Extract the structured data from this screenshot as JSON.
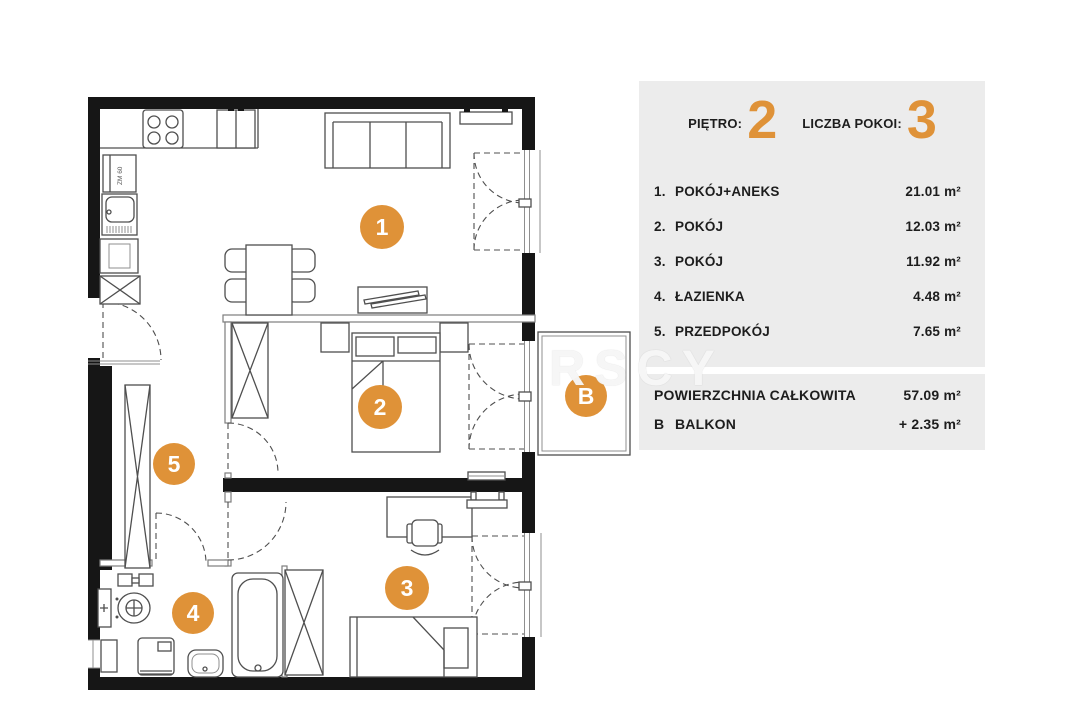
{
  "plan": {
    "markers": [
      "1",
      "2",
      "3",
      "4",
      "5",
      "B"
    ],
    "kitchen_unit_label": "ZM 60",
    "watermark": "RSCY"
  },
  "panel": {
    "floor": {
      "label": "PIĘTRO:",
      "value": "2"
    },
    "rooms_count": {
      "label": "LICZBA POKOI:",
      "value": "3"
    },
    "rooms": [
      {
        "no": "1.",
        "name": "POKÓJ+ANEKS",
        "area": "21.01 m²"
      },
      {
        "no": "2.",
        "name": "POKÓJ",
        "area": "12.03 m²"
      },
      {
        "no": "3.",
        "name": "POKÓJ",
        "area": "11.92 m²"
      },
      {
        "no": "4.",
        "name": "ŁAZIENKA",
        "area": "4.48 m²"
      },
      {
        "no": "5.",
        "name": "PRZEDPOKÓJ",
        "area": "7.65 m²"
      }
    ],
    "totals": [
      {
        "no": "",
        "name": "POWIERZCHNIA CAŁKOWITA",
        "area": "57.09 m²"
      },
      {
        "no": "B",
        "name": "BALKON",
        "area": "+ 2.35 m²"
      }
    ]
  },
  "colors": {
    "accent": "#DF9238",
    "panel_bg": "#ECECEC",
    "wall": "#161616"
  }
}
